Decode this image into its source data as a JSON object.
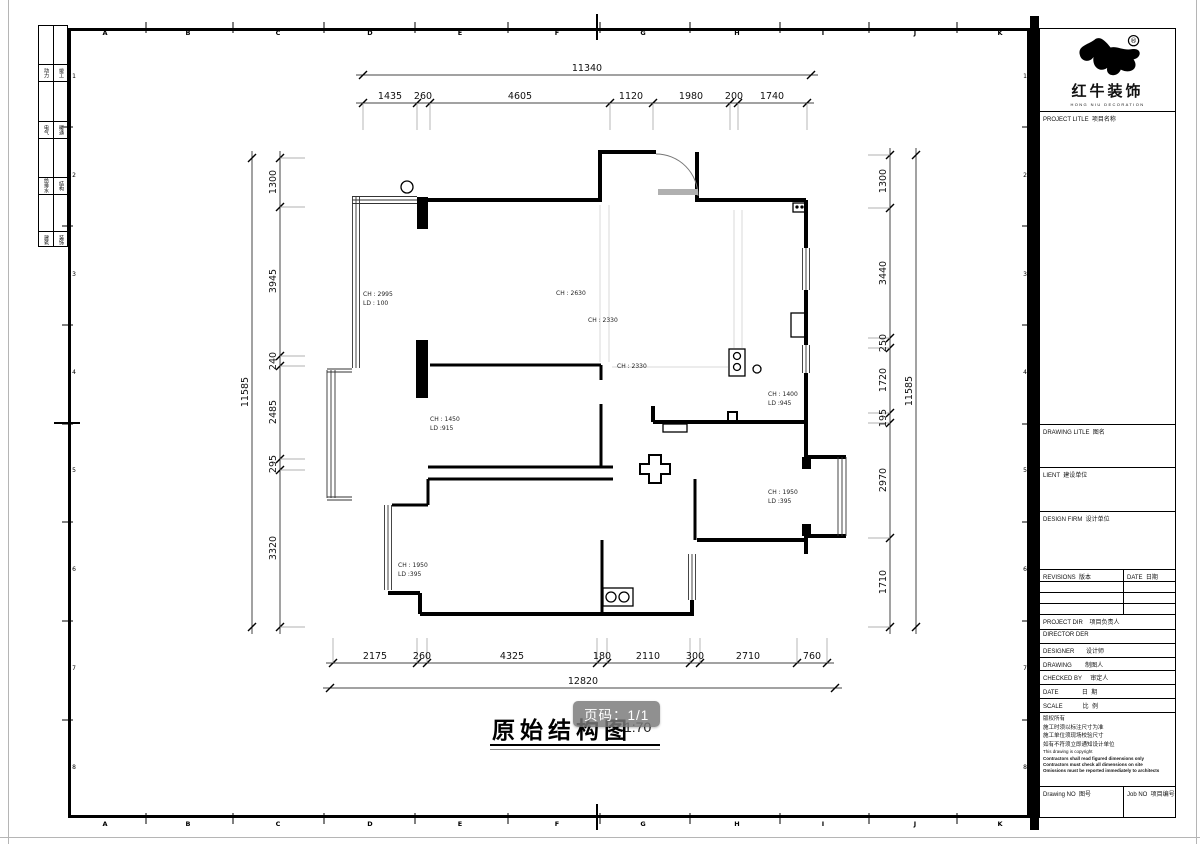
{
  "sheet": {
    "grid_letters": [
      "A",
      "B",
      "C",
      "D",
      "E",
      "F",
      "G",
      "H",
      "I",
      "J",
      "K"
    ],
    "row_numbers": [
      "1",
      "2",
      "3",
      "4",
      "5",
      "6",
      "7",
      "8"
    ],
    "sign_rows": [
      [
        "动力",
        "竣工"
      ],
      [
        "电气",
        "暖通"
      ],
      [
        "给排水",
        "结构"
      ],
      [
        "建筑",
        "装饰"
      ]
    ]
  },
  "brand": {
    "name": "红牛装饰",
    "sub": "HONG NIU DECORATION",
    "reg": "®"
  },
  "titleblock": {
    "project_title": "PROJECT LITLE  项目名称",
    "drawing_title": "DRAWING LITLE  图名",
    "client": "LIENT  建设单位",
    "design_firm": "DESIGN FIRM  设计单位",
    "revisions": "REVISIONS  版本",
    "rev_date": "DATE  日期",
    "project_dir": "PROJECT DIR    项目负责人",
    "director": "DIRECTOR DER",
    "designer": "DESIGNER       设计师",
    "drawing": "DRAWING        制图人",
    "checked": "CHECKED BY     审定人",
    "date": "DATE              日  期",
    "scale": "SCALE            比  例",
    "notes": [
      "版权所有",
      "施工时须以标注尺寸为准",
      "施工单位须现场校验尺寸",
      "如有不符须立即通知设计单位",
      "This drawing is copyright"
    ],
    "notes_bold": [
      "Contractors shall read figured dimensions only",
      "Contractors must check all dimensions on site",
      "Omissions must be reported immediately to architects"
    ],
    "drawing_no": "Drawing NO  图号",
    "job_no": "Job NO  项目编号"
  },
  "plan": {
    "dims": {
      "top_overall": "11340",
      "top": [
        "1435",
        "260",
        "4605",
        "1120",
        "1980",
        "200",
        "1740"
      ],
      "bottom": [
        "2175",
        "260",
        "4325",
        "180",
        "2110",
        "300",
        "2710",
        "760"
      ],
      "bottom_overall": "12820",
      "left": [
        "1300",
        "3945",
        "240",
        "2485",
        "295",
        "3320"
      ],
      "left_overall": "11585",
      "right": [
        "1300",
        "3440",
        "250",
        "1720",
        "195",
        "2970",
        "1710"
      ],
      "right_overall": "11585"
    },
    "labels": [
      {
        "t1": "CH : 2995",
        "t2": "LD : 100"
      },
      {
        "t1": "CH : 2630"
      },
      {
        "t1": "CH : 2330"
      },
      {
        "t1": "CH : 2330"
      },
      {
        "t1": "CH : 1400",
        "t2": "LD :945"
      },
      {
        "t1": "CH : 1450",
        "t2": "LD :915"
      },
      {
        "t1": "CH : 1950",
        "t2": "LD :395"
      },
      {
        "t1": "CH : 1950",
        "t2": "LD :395"
      }
    ]
  },
  "footer": {
    "title": "原始结构图",
    "scale": "1:70",
    "page_badge": "页码：1/1"
  }
}
